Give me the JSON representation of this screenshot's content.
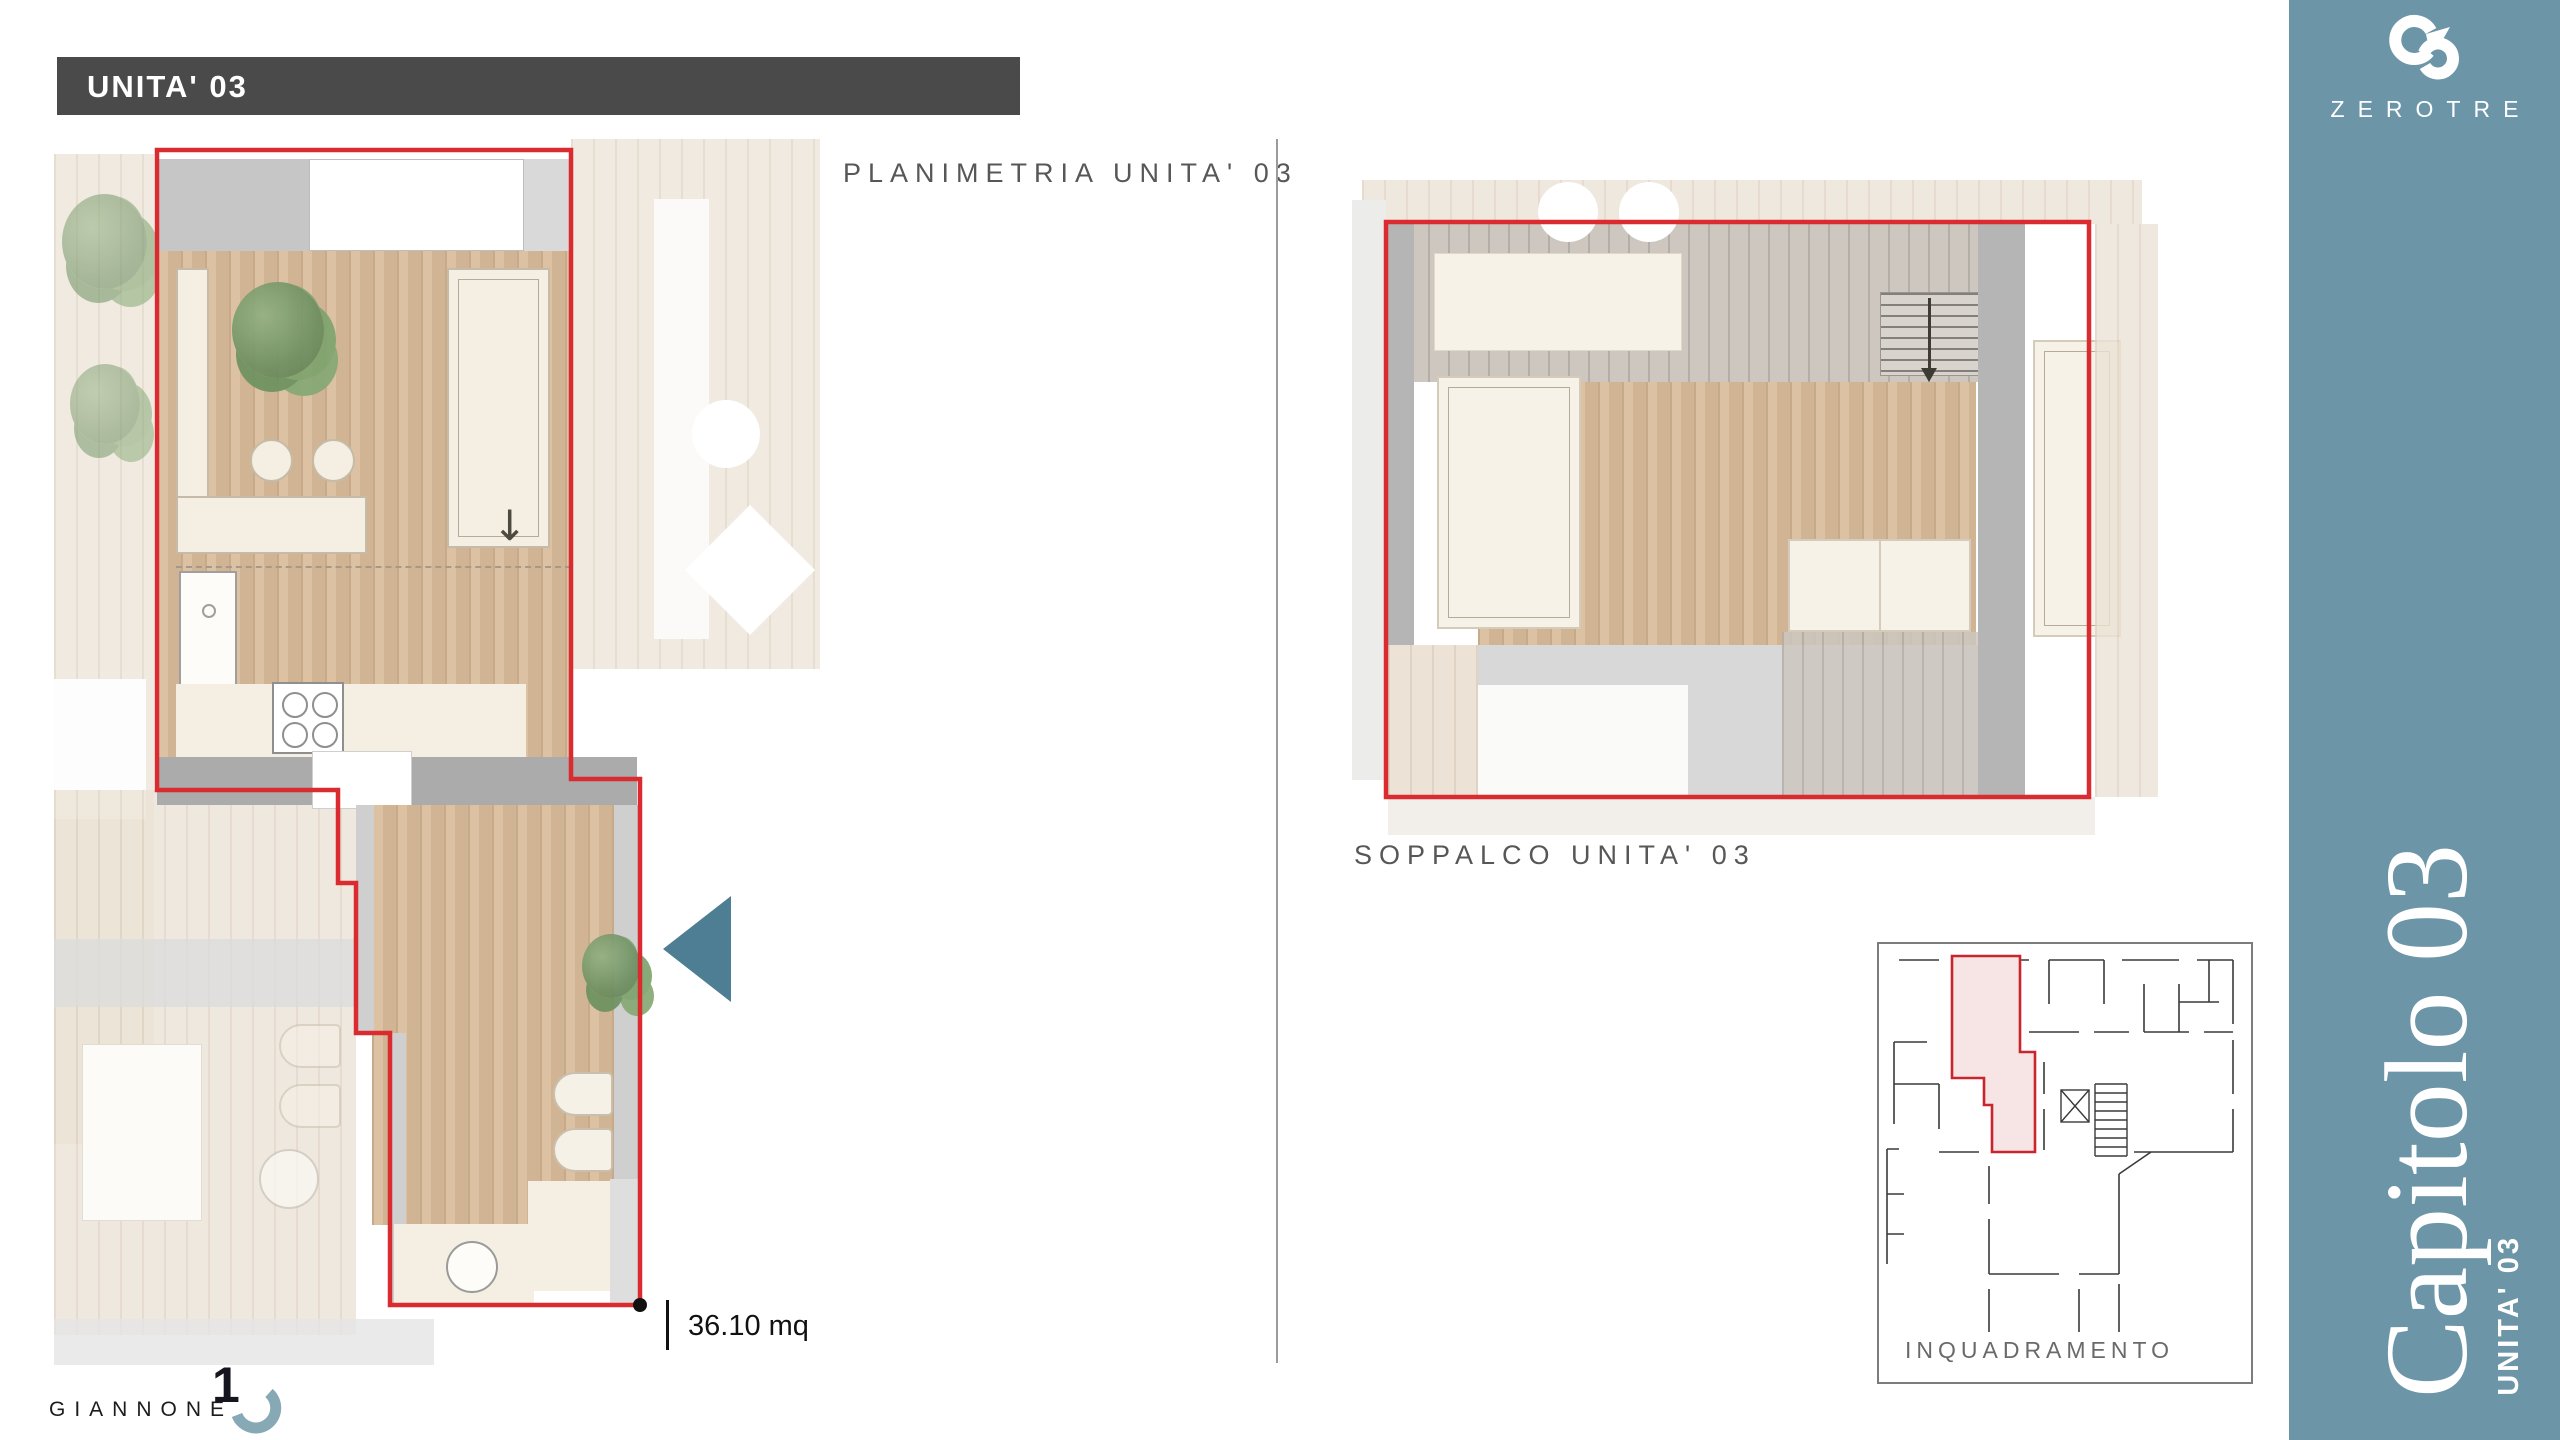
{
  "header": {
    "title": "UNITA' 03"
  },
  "planimetria": {
    "label": "PLANIMETRIA UNITA' 03",
    "area": "36.10 mq"
  },
  "soppalco": {
    "label": "SOPPALCO UNITA' 03"
  },
  "inquadramento": {
    "label": "INQUADRAMENTO"
  },
  "sidebar": {
    "brand": "ZEROTRE",
    "chapter": "Capitolo 03",
    "unit": "UNITA' 03",
    "color": "#6c96a8",
    "logo_icon": "zerotre-03-monogram-icon"
  },
  "footer": {
    "studio": "GIANNONE",
    "logo_numeral": "1",
    "logo_icon": "giannone-arc-icon"
  },
  "icons": {
    "entrance_arrow": "left-triangle",
    "stairs_direction": "down-arrow",
    "plan_arrow_glyph": "↓"
  },
  "colors": {
    "accent_red": "#da2c30",
    "header_bar": "#4a4a4a",
    "sidebar_teal": "#6c96a8",
    "arrow_teal": "#4e7e93",
    "label_gray": "#575757",
    "wood_warm": "#d8bb99",
    "wood_faded": "#ece3d6",
    "wood_gray": "#cdc7c0",
    "wall_gray": "#b5b5b5",
    "cream": "#f4efe2"
  }
}
